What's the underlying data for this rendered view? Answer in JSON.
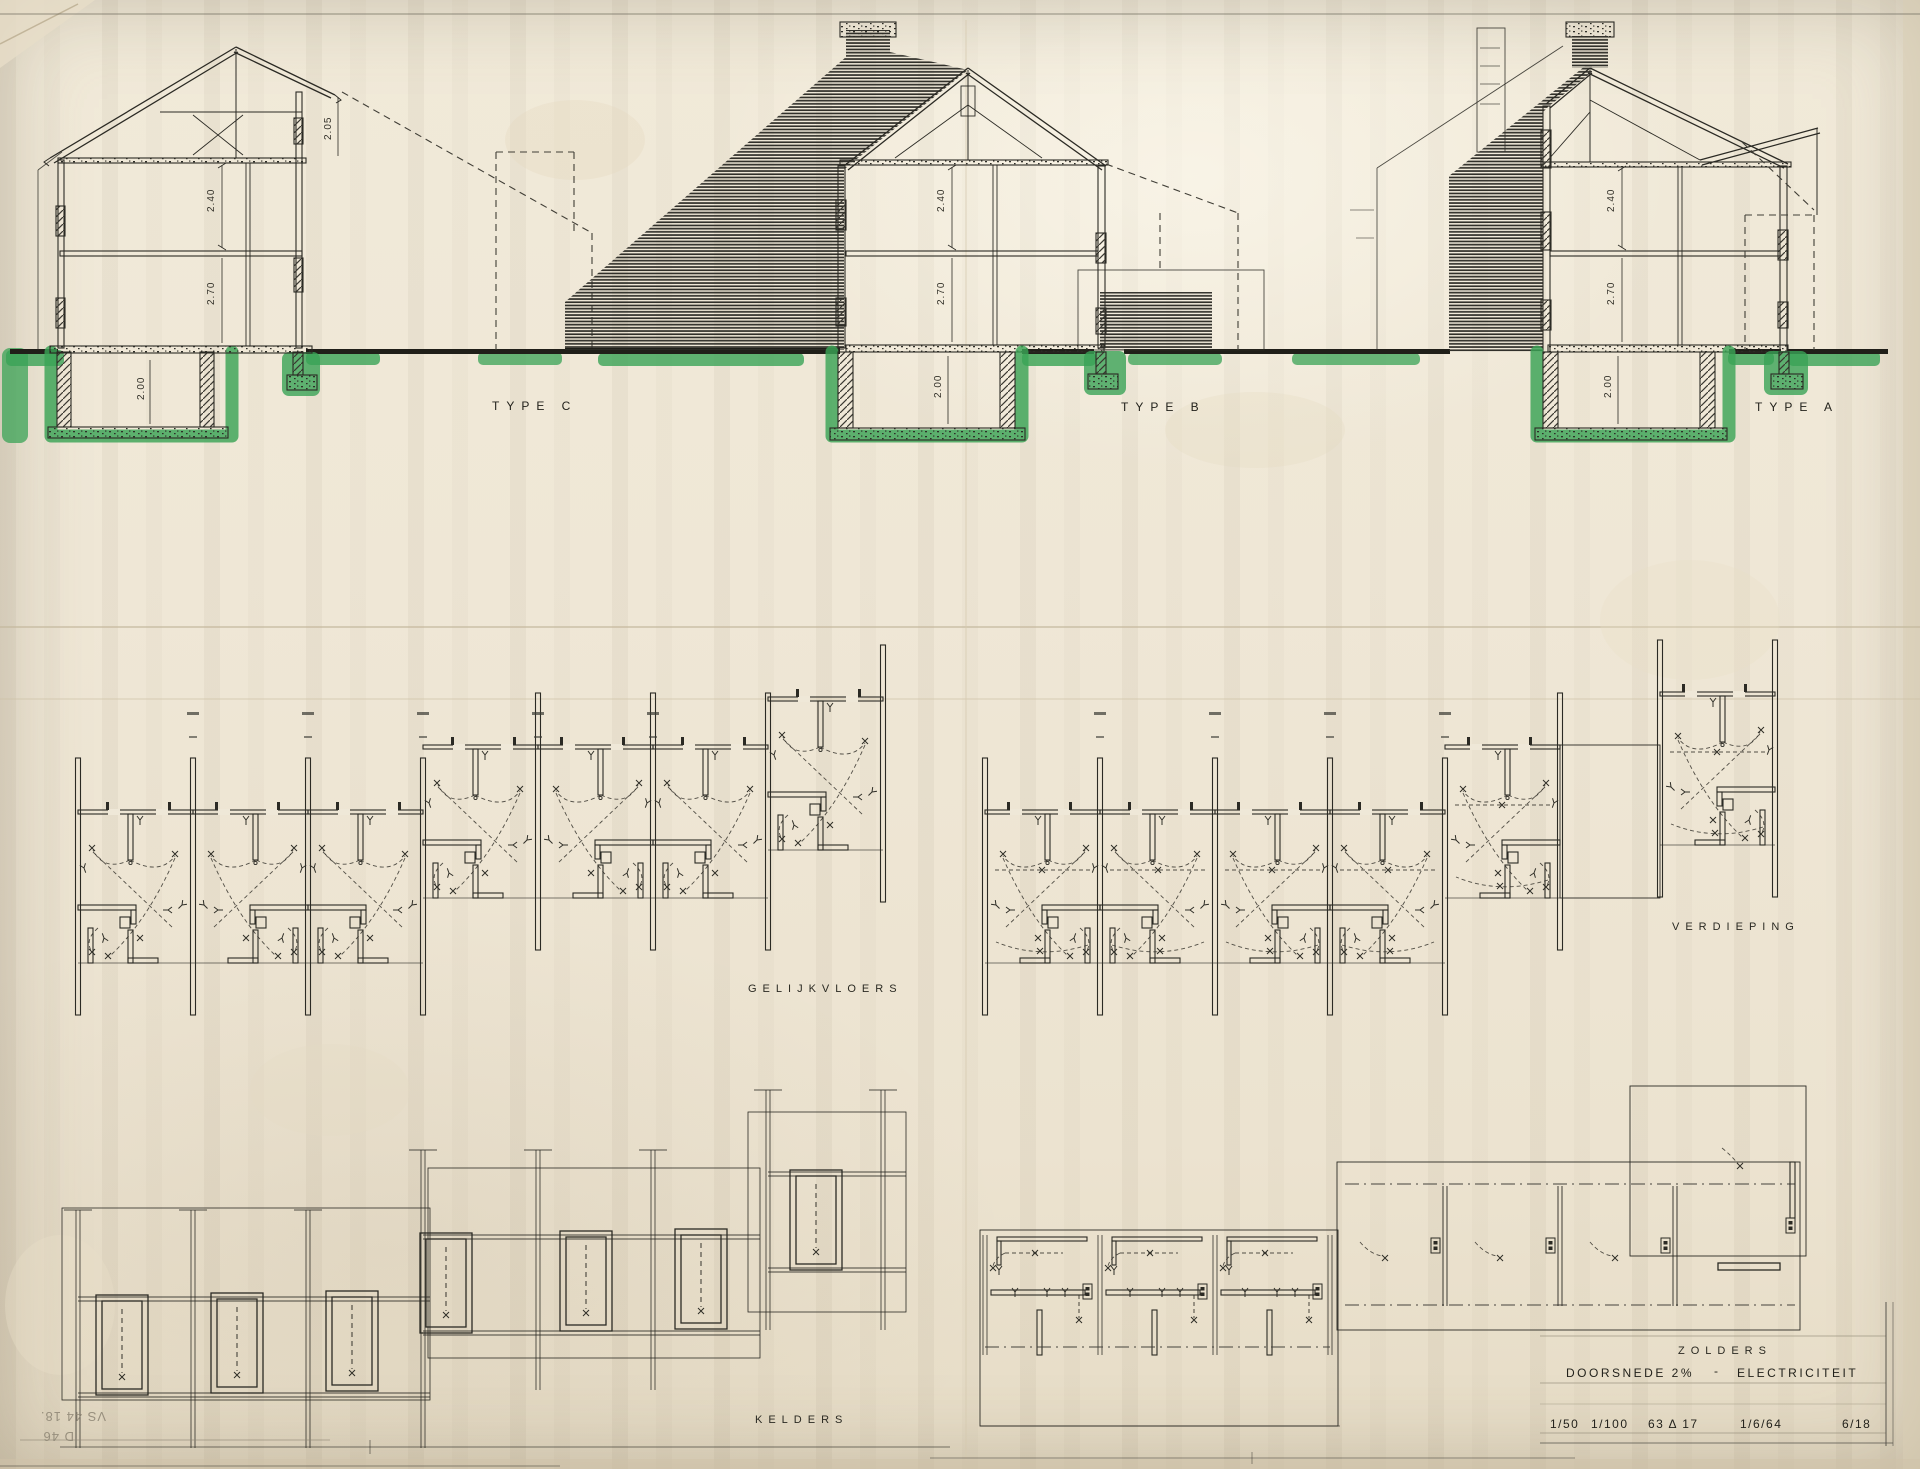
{
  "document": {
    "type_labels": {
      "c": "TYPE C",
      "b": "TYPE B",
      "a": "TYPE A"
    },
    "plan_labels": {
      "ground_floor": "GELIJKVLOERS",
      "upper_floor": "VERDIEPING",
      "cellars": "KELDERS",
      "attics": "ZOLDERS"
    },
    "title_block": {
      "drawing_title": "DOORSNEDE 2%",
      "separator": "-",
      "subject": "ELECTRICITEIT",
      "scale_small": "1/50",
      "scale_large": "1/100",
      "project_code": "63 Δ 17",
      "date": "1/6/64",
      "sheet_number": "6/18"
    },
    "dimensions": {
      "attic": "2.05",
      "upper": "2.40",
      "ground": "2.70",
      "cellar": "2.00"
    },
    "corner_note": {
      "line1": "VS 44 18.",
      "line2": "D 46"
    },
    "colors": {
      "ground_highlight": "#3aa356",
      "ink": "#2b2a24",
      "paper": "#efe8d8"
    }
  }
}
